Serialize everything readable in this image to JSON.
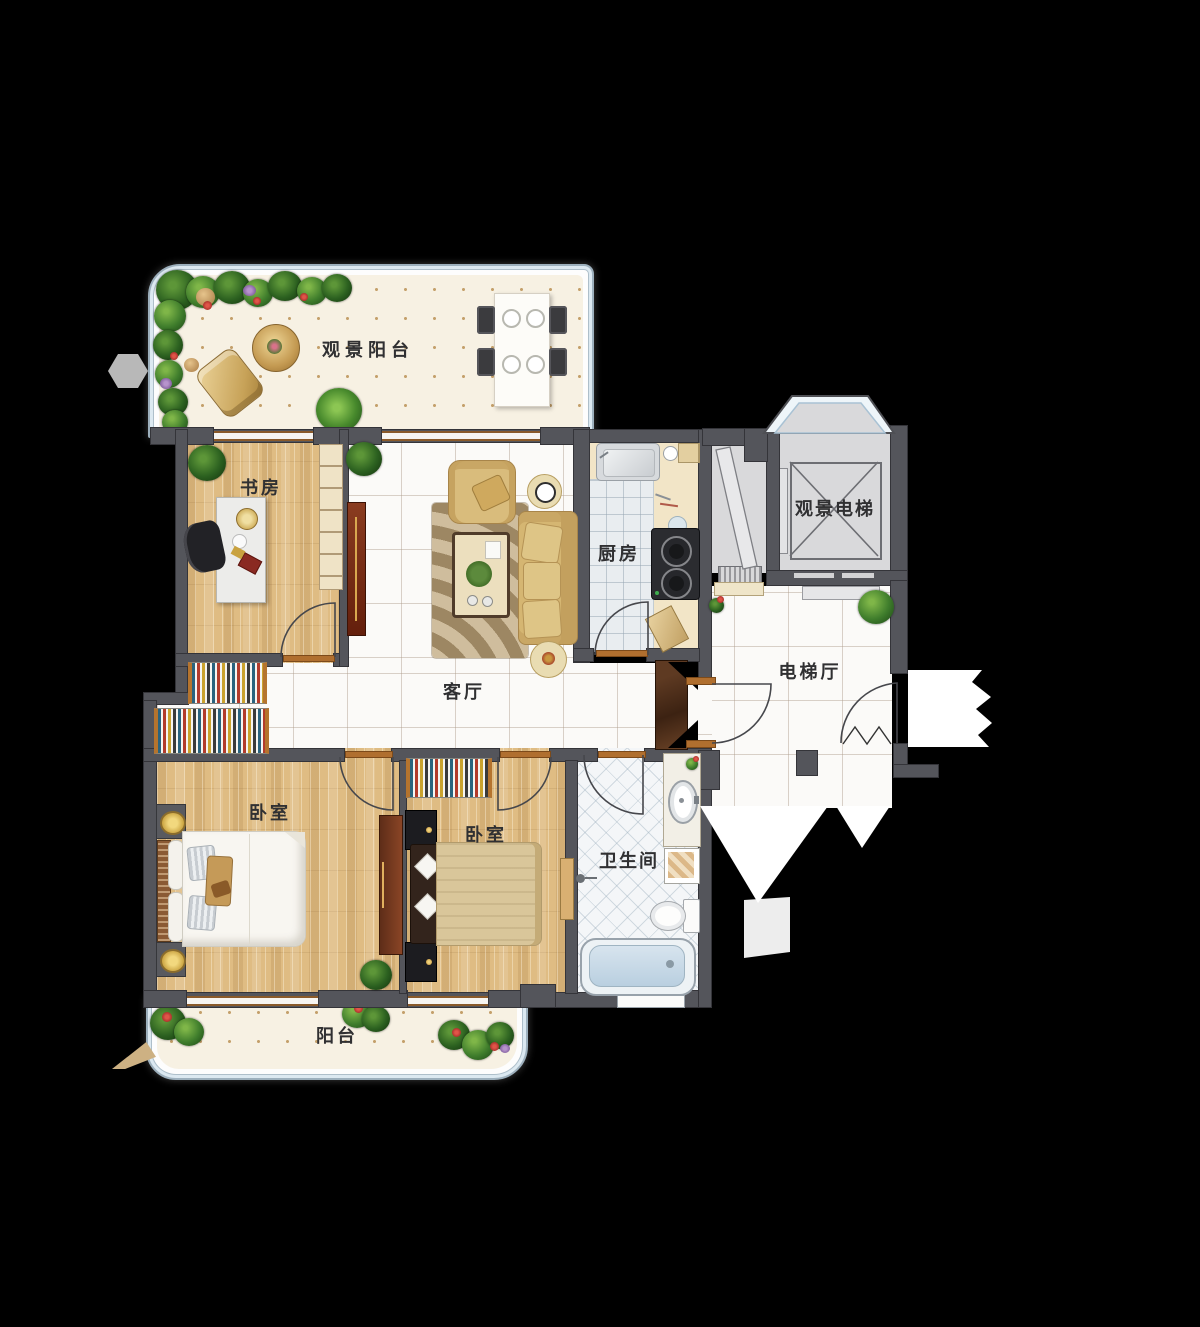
{
  "plan": {
    "type": "residential-floor-plan",
    "rooms": [
      {
        "id": "view-balcony",
        "label": "观景阳台"
      },
      {
        "id": "study",
        "label": "书房"
      },
      {
        "id": "kitchen",
        "label": "厨房"
      },
      {
        "id": "view-elevator",
        "label": "观景电梯"
      },
      {
        "id": "living-room",
        "label": "客厅"
      },
      {
        "id": "elevator-hall",
        "label": "电梯厅"
      },
      {
        "id": "bedroom-left",
        "label": "卧室"
      },
      {
        "id": "bedroom-right",
        "label": "卧室"
      },
      {
        "id": "bathroom",
        "label": "卫生间"
      },
      {
        "id": "balcony",
        "label": "阳台"
      }
    ],
    "colors": {
      "background": "#000000",
      "wall": "#54555b",
      "wood_floor": "#dfbc83",
      "marble_floor": "#fbfaf8",
      "kitchen_tile": "#e9edf0",
      "bath_tile": "#f4f6f8",
      "balcony_floor": "#f7f1e3",
      "railing_glass": "#dce9f1",
      "counter": "#f2e5c7",
      "sofa_gold": "#d5b672",
      "wardrobe_red": "#7c3a23",
      "elevator_gray": "#d9d9db",
      "plant_green": "#3f7d2c",
      "threshold_brown": "#b06f2f"
    }
  }
}
